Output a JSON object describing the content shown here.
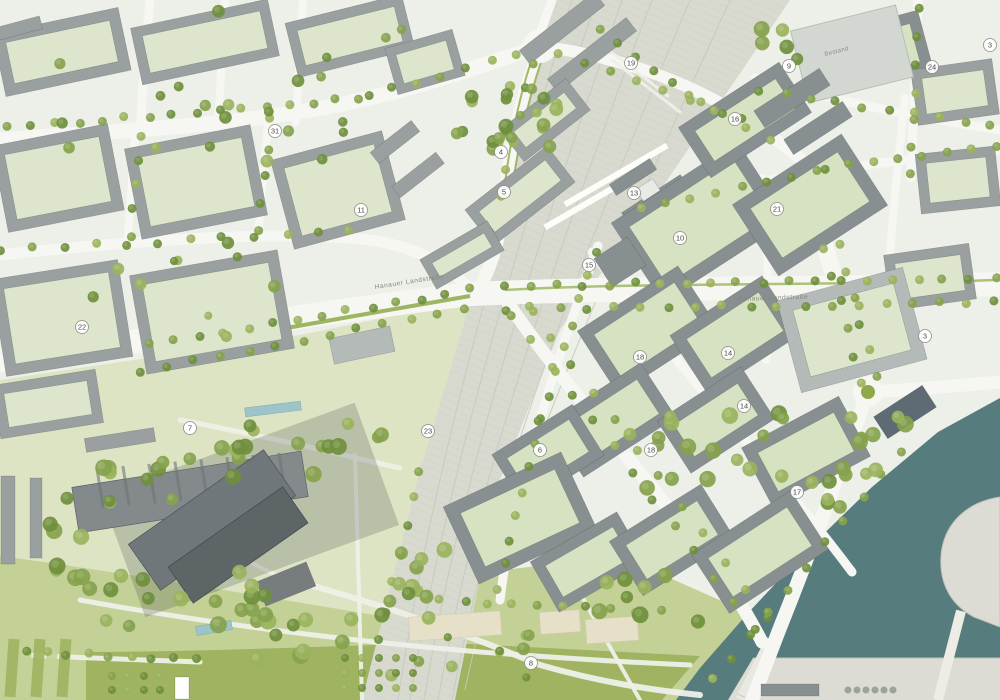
{
  "map": {
    "description": "Urban masterplan site plan with numbered parcels, railway corridor, Hanauer Landstrasse, park and harbor basin",
    "palette": {
      "base": "#edefe9",
      "road": "#f6f7f3",
      "parcel": "#dde5cd",
      "parcelNew": "#d7e2c3",
      "parkPale": "#dde4c4",
      "parkMid": "#c3d197",
      "parkVivid": "#9fb360",
      "tree": "#85a24c",
      "treeDark": "#6f8f3c",
      "treeLight": "#9ab35c",
      "building": "#9aa09f",
      "buildingNew": "#878f91",
      "buildingDark": "#70777a",
      "buildingDarker": "#5e6567",
      "buildingLight": "#b4bab8",
      "bestand": "#d3d7d2",
      "rail": "#d8dad0",
      "railHatch": "#c6c9bd",
      "water": "#567c7d",
      "sand": "#e6e0c8",
      "beige": "#dcdcd5",
      "median": "#8ea947",
      "pond": "#9dc4c8",
      "markerBorder": "#8d8d89",
      "markerText": "#4a4a4a",
      "label": "#86867f"
    },
    "street_labels": [
      {
        "text": "Hanauer Landstraße",
        "x": 375,
        "y": 289,
        "rotate": -9
      },
      {
        "text": "Hanauer Landstraße",
        "x": 738,
        "y": 301,
        "rotate": -2
      }
    ],
    "building_labels": [
      {
        "text": "Bestand",
        "x": 837,
        "y": 53,
        "rotate": -14
      }
    ],
    "markers": [
      {
        "label": "31",
        "x": 275,
        "y": 131
      },
      {
        "label": "11",
        "x": 361,
        "y": 210
      },
      {
        "label": "22",
        "x": 82,
        "y": 327
      },
      {
        "label": "7",
        "x": 190,
        "y": 428
      },
      {
        "label": "4",
        "x": 501,
        "y": 152
      },
      {
        "label": "5",
        "x": 504,
        "y": 192
      },
      {
        "label": "19",
        "x": 631,
        "y": 63
      },
      {
        "label": "13",
        "x": 634,
        "y": 193
      },
      {
        "label": "15",
        "x": 589,
        "y": 265
      },
      {
        "label": "10",
        "x": 680,
        "y": 238
      },
      {
        "label": "16",
        "x": 735,
        "y": 119
      },
      {
        "label": "21",
        "x": 777,
        "y": 209
      },
      {
        "label": "9",
        "x": 789,
        "y": 66
      },
      {
        "label": "24",
        "x": 932,
        "y": 67
      },
      {
        "label": "3",
        "x": 990,
        "y": 45
      },
      {
        "label": "3",
        "x": 925,
        "y": 336
      },
      {
        "label": "18",
        "x": 640,
        "y": 357
      },
      {
        "label": "14",
        "x": 728,
        "y": 353
      },
      {
        "label": "14",
        "x": 744,
        "y": 406
      },
      {
        "label": "23",
        "x": 428,
        "y": 431
      },
      {
        "label": "6",
        "x": 540,
        "y": 450
      },
      {
        "label": "18",
        "x": 651,
        "y": 450
      },
      {
        "label": "17",
        "x": 797,
        "y": 492
      },
      {
        "label": "8",
        "x": 531,
        "y": 663
      }
    ]
  }
}
